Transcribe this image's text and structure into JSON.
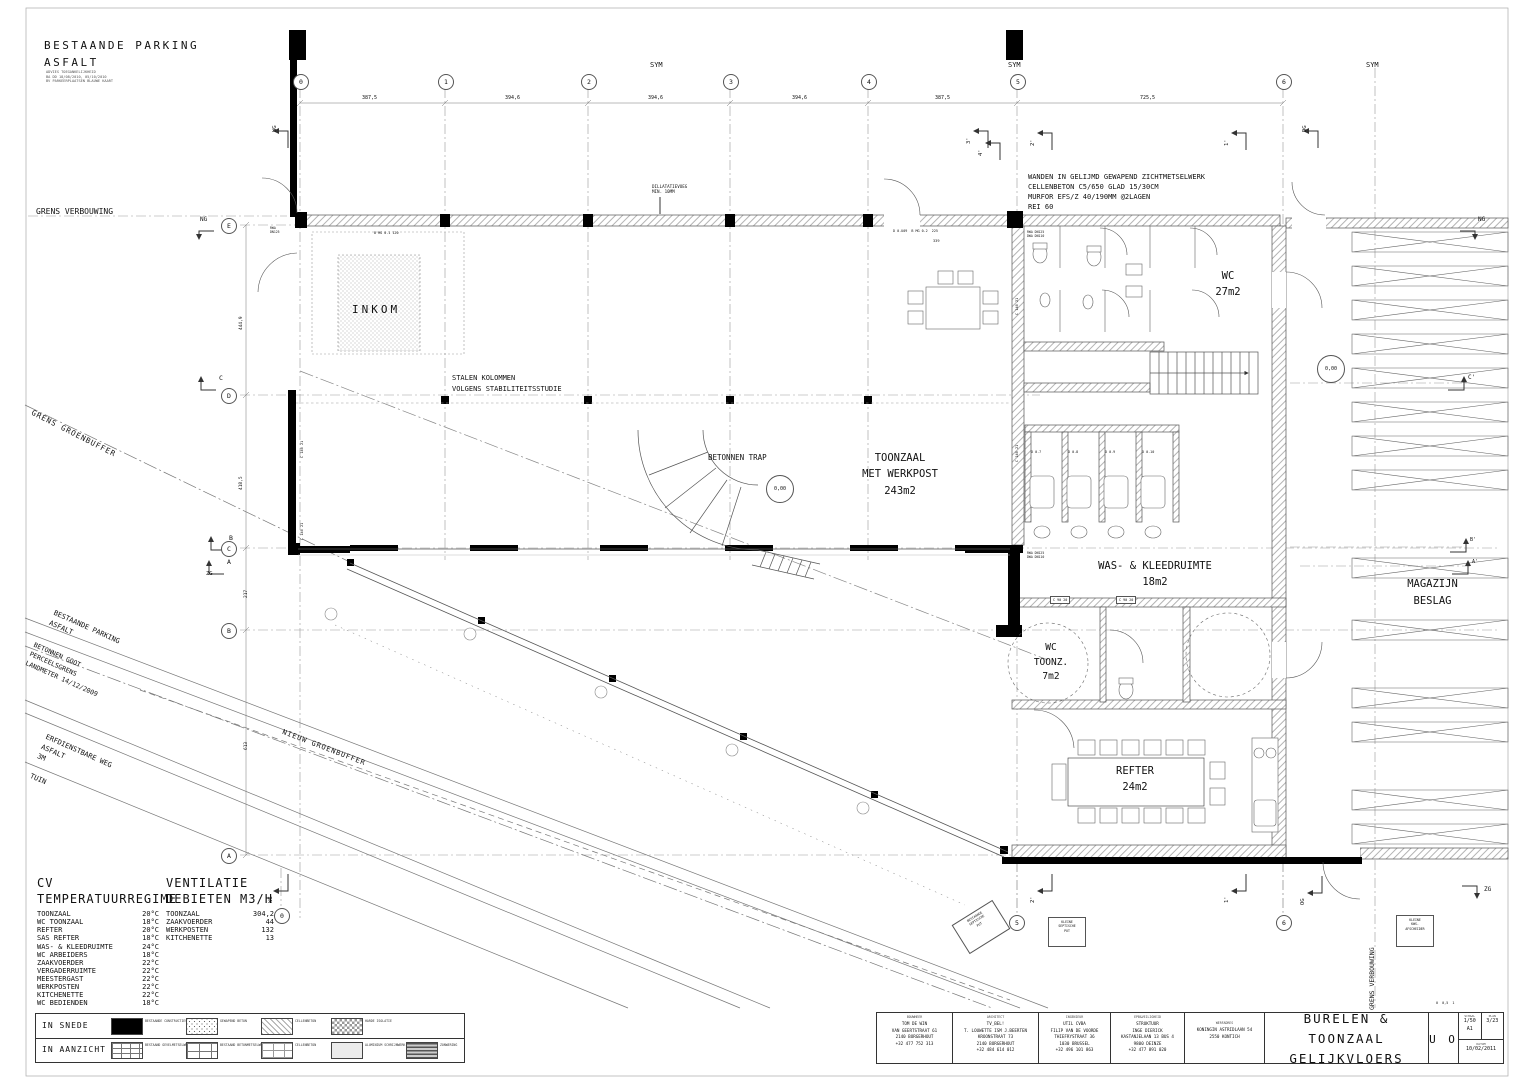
{
  "labels": {
    "parking_title": "BESTAANDE PARKING\nASFALT",
    "parking_sub": "ADVIES TOEGANKELIJKHEID\nBA DD 18/08/2010, 05/10/2010\nBV PARKEERPLAATSEN BLAUWE KAART",
    "grens_verbouwing": "GRENS VERBOUWING",
    "grens_verbouwing_v": "GRENS VERBOUWING",
    "ng": "NG",
    "sym": "SYM",
    "wanden_note": "WANDEN IN GELIJMD GEWAPEND ZICHTMETSELWERK\nCELLENBETON C5/650 GLAD 15/30CM\nMURFOR EFS/Z 40/190MM @2LAGEN\nREI 60",
    "dilatatie": "DILLATATIEVOEG\nMIN. 10MM",
    "inkom": "INKOM",
    "stalen": "STALEN KOLOMMEN\nVOLGENS STABILITEITSSTUDIE",
    "betonnen_trap": "BETONNEN TRAP",
    "toonzaal": "TOONZAAL\nMET WERKPOST\n243m2",
    "wc": "WC\n27m2",
    "was": "WAS- & KLEEDRUIMTE\n18m2",
    "wctoonz": "WC\nTOONZ.\n7m2",
    "refter": "REFTER\n24m2",
    "magazijn": "MAGAZIJN\nBESLAG",
    "level": "0,00",
    "grens_groenbuffer": "GRENS GROENBUFFER",
    "parking_diag": "BESTAANDE PARKING\nASFALT",
    "goot": "BETONNEN GOOT\nPERCEELSGRENS\nLANDMETER 14/12/2009",
    "nieuw_groenbuffer": "NIEUW GROENBUFFER",
    "erfweg": "ERFDIENSTBARE WEG\nASFALT\n3M",
    "tuin": "TUIN",
    "d387a": "387,5",
    "d394a": "394,6",
    "d394b": "394,6",
    "d394c": "394,6",
    "d387b": "387,5",
    "d725": "725,5",
    "d4449": "444,9",
    "d4185": "418,5",
    "d217": "217",
    "d613": "613",
    "d339": "339",
    "c14021": "C 140 21",
    "c9020": "C 90 20",
    "d07": "D 0.7",
    "d08": "D 0.8",
    "d09": "D 0.9",
    "d010": "D 0.10",
    "rwa": "RWA\nDN125",
    "rwadwa": "RWA DN125\nDWA DN110",
    "bmg1": "B MG 0.1 120",
    "bmg2": "D 0.U09  B MG 0.2  225",
    "sept1": "BESTAANDE\nSEPTISCHE\nPUT",
    "sept2": "KLEINE\nSEPTISCHE\nPUT",
    "kws": "KLEINE\nKWS-\nAFSCHEIDER",
    "wg": "WG",
    "dg": "DG",
    "og": "OG",
    "zg": "ZG",
    "p1": "1'",
    "p2": "2'",
    "p3": "3'",
    "p4": "4'",
    "cacc": "C'",
    "bacc": "B'",
    "aacc": "A'",
    "sC": "C",
    "sB": "B",
    "sA": "A",
    "minibar": "0  0,5  1",
    "g0": "0",
    "g1": "1",
    "g2": "2",
    "g3": "3",
    "g4": "4",
    "g5": "5",
    "g6": "6",
    "gE": "E",
    "gD": "D",
    "gC": "C",
    "gB": "B",
    "gA": "A"
  },
  "cv": {
    "title1": "CV",
    "title2": "TEMPERATUURREGIME",
    "rows": [
      {
        "label": "TOONZAAL",
        "value": "20°C"
      },
      {
        "label": "WC TOONZAAL",
        "value": "18°C"
      },
      {
        "label": "REFTER",
        "value": "20°C"
      },
      {
        "label": "SAS REFTER",
        "value": "18°C"
      },
      {
        "label": "WAS- & KLEEDRUIMTE",
        "value": "24°C"
      },
      {
        "label": "WC ARBEIDERS",
        "value": "18°C"
      },
      {
        "label": "ZAAKVOERDER",
        "value": "22°C"
      },
      {
        "label": "VERGADERRUIMTE",
        "value": "22°C"
      },
      {
        "label": "MEESTERGAST",
        "value": "22°C"
      },
      {
        "label": "WERKPOSTEN",
        "value": "22°C"
      },
      {
        "label": "KITCHENETTE",
        "value": "22°C"
      },
      {
        "label": "WC BEDIENDEN",
        "value": "18°C"
      }
    ]
  },
  "vent": {
    "title1": "VENTILATIE",
    "title2": "DEBIETEN M3/H",
    "rows": [
      {
        "label": "TOONZAAL",
        "value": "304,2"
      },
      {
        "label": "ZAAKVOERDER",
        "value": "44"
      },
      {
        "label": "WERKPOSTEN",
        "value": "132"
      },
      {
        "label": "KITCHENETTE",
        "value": "13"
      }
    ]
  },
  "legend": {
    "snede": "IN SNEDE",
    "aanzicht": "IN AANZICHT",
    "row1": [
      "BESTAANDE CONSTRUCTIES",
      "GEWAPEND BETON",
      "CELLENBETON",
      "HARDE ISOLATIE"
    ],
    "row2": [
      "BESTAAND GEVELMETSELWERK",
      "BESTAAND BETONMETSELWERK",
      "CELLENBETON",
      "ALUMINIUM SCHRIJNWERK",
      "ZONWERING"
    ]
  },
  "titleblock": {
    "cols": [
      {
        "header": "BOUWHEER",
        "lines": [
          "TOM DE WIN",
          "VAN GEERTSTRAAT 61",
          "2140 BORGERHOUT",
          "+32 477 752 313"
        ]
      },
      {
        "header": "ARCHITECT",
        "lines": [
          "TV_BEL!",
          "T. LOUWETTE ISM J.BEERTEN",
          "KROONSTRAAT 73",
          "2140 BORGERHOUT",
          "+32 484 614 012"
        ]
      },
      {
        "header": "INGENIEUR",
        "lines": [
          "UTIL CVBA",
          "FILIP VAN DE VOORDE",
          "THIEFRYSTRAAT 36",
          "1030 BRUSSEL",
          "+32 496 101 863"
        ]
      },
      {
        "header": "EPB&VEILIGHEID",
        "lines": [
          "STRUKTUUR",
          "INGE DIERICK",
          "KASTANJELAAN 13 BUS 4",
          "9800 DEINZE",
          "+32 477 891 020"
        ]
      },
      {
        "header": "WERFADRES",
        "lines": [
          "KONINGIN ASTRIDLAAN 54",
          "2550 KONTICH"
        ]
      }
    ],
    "title1": "BURELEN & TOONZAAL",
    "title2": "GELIJKVLOERS",
    "stamp": "U O",
    "schaal_label": "SCHAAL",
    "schaal": "1/50\nA1",
    "plan_label": "PLAN",
    "plan": "3/23",
    "datum_label": "DATUM",
    "datum": "10/02/2011"
  }
}
